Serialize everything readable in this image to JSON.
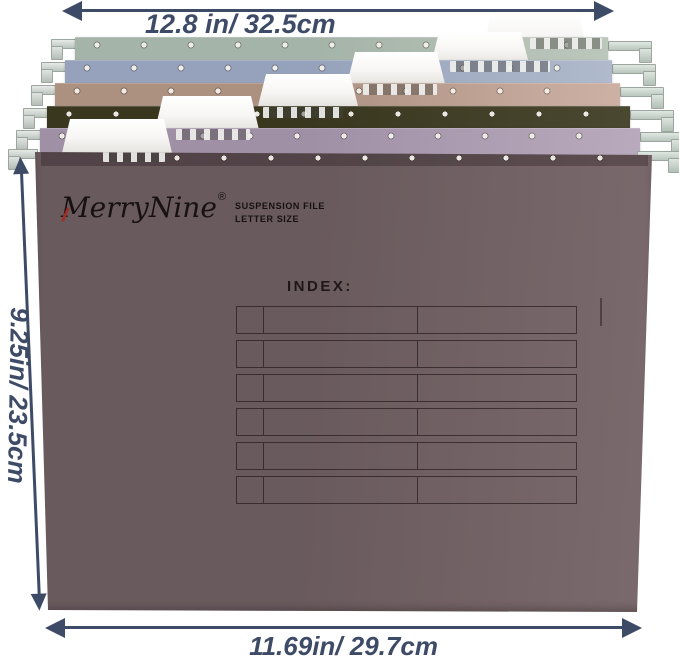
{
  "dimensions": {
    "top_width": "12.8 in/ 32.5cm",
    "side_height": "9.25in/ 23.5cm",
    "bottom_width": "11.69in/ 29.7cm"
  },
  "brand": {
    "name": "MerryNine",
    "registered": "®",
    "line1": "SUSPENSION FILE",
    "line2": "LETTER SIZE"
  },
  "front_panel": {
    "index_label": "INDEX:"
  },
  "index_table": {
    "rows": 6,
    "columns": 3
  },
  "colors": {
    "annotation": "#3e4b67",
    "brand_text": "#171113",
    "brand_accent": "#9c3227",
    "table_line": "#3c3034",
    "tab_white": "#f7f6f4"
  },
  "folders": [
    {
      "name": "sage-green",
      "color": "#a5b4a8",
      "color_light": "#bcc7bc"
    },
    {
      "name": "blue-gray",
      "color": "#96a2bb",
      "color_light": "#b0bacc"
    },
    {
      "name": "tan",
      "color": "#ac9181",
      "color_light": "#cdb1a5"
    },
    {
      "name": "dark-olive",
      "color": "#39381f",
      "color_light": "#4a4830"
    },
    {
      "name": "lavender",
      "color": "#a090a6",
      "color_light": "#b9aabd"
    },
    {
      "name": "mauve-front",
      "color": "#695a5d",
      "color_light": "#7b6a6d"
    }
  ]
}
